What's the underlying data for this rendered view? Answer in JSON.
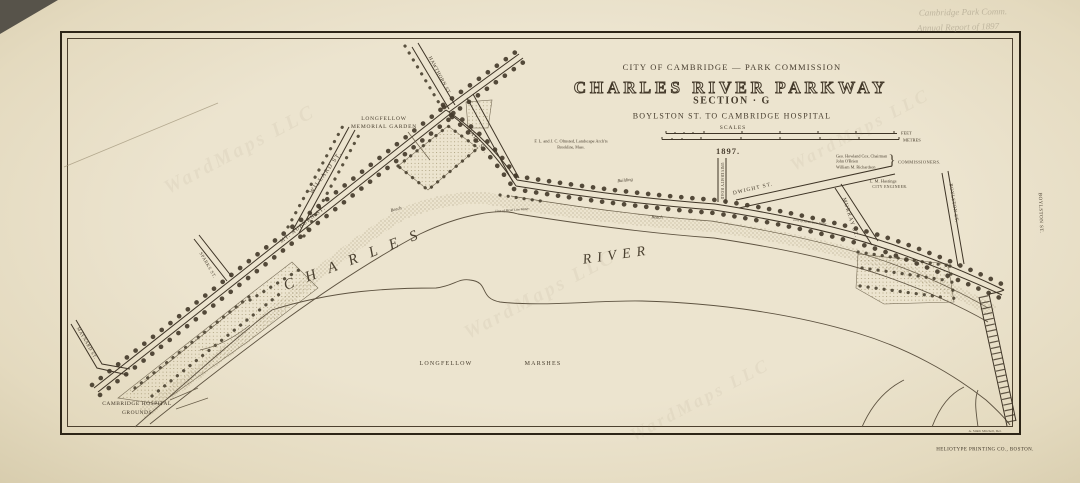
{
  "colors": {
    "ink": "#3e3426",
    "paper": "#e9e1ca",
    "stipple": "#8a7c5c"
  },
  "pencil": {
    "line1": "Cambridge Park Comm.",
    "line2": "Annual Report of 1897"
  },
  "watermark": "WardMaps LLC",
  "title_block": {
    "commission": "CITY OF CAMBRIDGE — PARK COMMISSION",
    "title": "CHARLES RIVER PARKWAY",
    "section": "SECTION · G",
    "subtitle": "BOYLSTON ST. TO CAMBRIDGE HOSPITAL",
    "scales_label": "SCALES",
    "feet_label": "FEET",
    "metres_label": "METRES",
    "date": "1897."
  },
  "credits": {
    "architects_line1": "F. L. and J. C. Olmsted, Landscape Arch'ts",
    "architects_line2": "Brookline, Mass.",
    "commissioner1": "Geo. Howland Cox, Chairman",
    "commissioner2": "John O'Brien",
    "commissioner3": "William M. Richardson",
    "brace": "}",
    "commissioners_label": "COMMISSIONERS.",
    "engineer_name": "L. M. Hastings",
    "engineer_title": "CITY ENGINEER.",
    "delineator": "A. Smith Mitchell, Del.",
    "printer": "HELIOTYPE PRINTING CO., BOSTON."
  },
  "map": {
    "streets": {
      "hawthorn": "HAWTHORN ST.",
      "bath": "BATH ST.",
      "willard": "WILLARD ST.",
      "sparks": "SPARKS ST.",
      "mt_auburn": "MT. AUBURN ST.",
      "maynard": "MAYNARD ST.",
      "university_road": "UNIVERSITY ROAD",
      "dwight": "DWIGHT ST.",
      "murray": "MURRAY ST.",
      "boylston": "BOYLSTON ST.",
      "boylston_bridge": "BOYLSTON ST."
    },
    "features": {
      "river_word1": "CHARLES",
      "river_word2": "RIVER",
      "marsh_word1": "LONGFELLOW",
      "marsh_word2": "MARSHES",
      "memorial_garden_line1": "LONGFELLOW",
      "memorial_garden_line2": "MEMORIAL GARDEN",
      "hospital_line1": "CAMBRIDGE HOSPITAL",
      "hospital_line2": "GROUNDS",
      "building": "Building",
      "beach": "Beach",
      "low_water": "Line of Mean Low Water"
    }
  }
}
